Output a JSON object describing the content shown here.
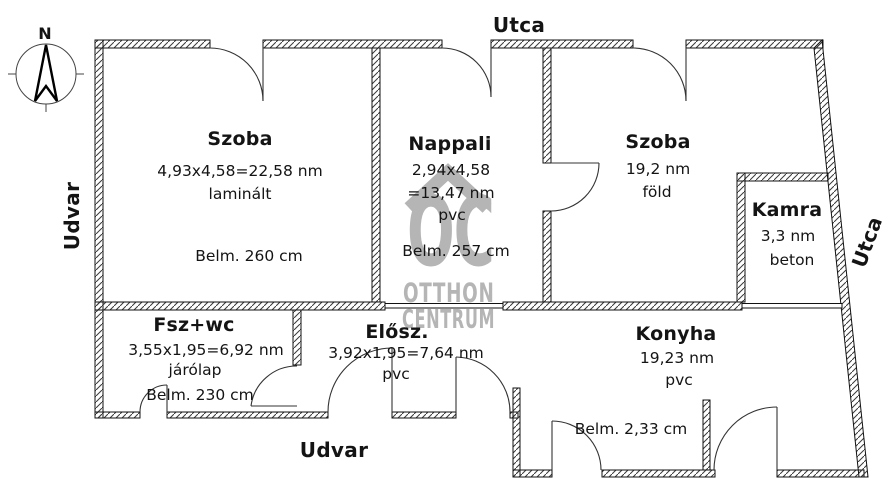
{
  "surroundings": {
    "top": "Utca",
    "left": "Udvar",
    "right": "Utca",
    "bottom": "Udvar"
  },
  "compass": {
    "north_label": "N"
  },
  "watermark": {
    "initials": "OC",
    "line1": "OTTHON",
    "line2": "CENTRUM"
  },
  "rooms": {
    "szoba1": {
      "name": "Szoba",
      "dimensions": "4,93x4,58=22,58 nm",
      "floor": "laminált",
      "height": "Belm. 260 cm"
    },
    "nappali": {
      "name": "Nappali",
      "dimensions_line1": "2,94x4,58",
      "dimensions_line2": "=13,47 nm",
      "floor": "pvc",
      "height": "Belm. 257 cm"
    },
    "szoba2": {
      "name": "Szoba",
      "area": "19,2 nm",
      "floor": "föld"
    },
    "kamra": {
      "name": "Kamra",
      "area": "3,3 nm",
      "floor": "beton"
    },
    "fszwc": {
      "name": "Fsz+wc",
      "dimensions": "3,55x1,95=6,92 nm",
      "floor": "járólap",
      "height": "Belm. 230 cm"
    },
    "elosz": {
      "name": "Elősz.",
      "dimensions": "3,92x1,95=7,64 nm",
      "floor": "pvc"
    },
    "konyha": {
      "name": "Konyha",
      "area": "19,23 nm",
      "floor": "pvc",
      "door_height": "Belm. 2,33 cm"
    }
  }
}
